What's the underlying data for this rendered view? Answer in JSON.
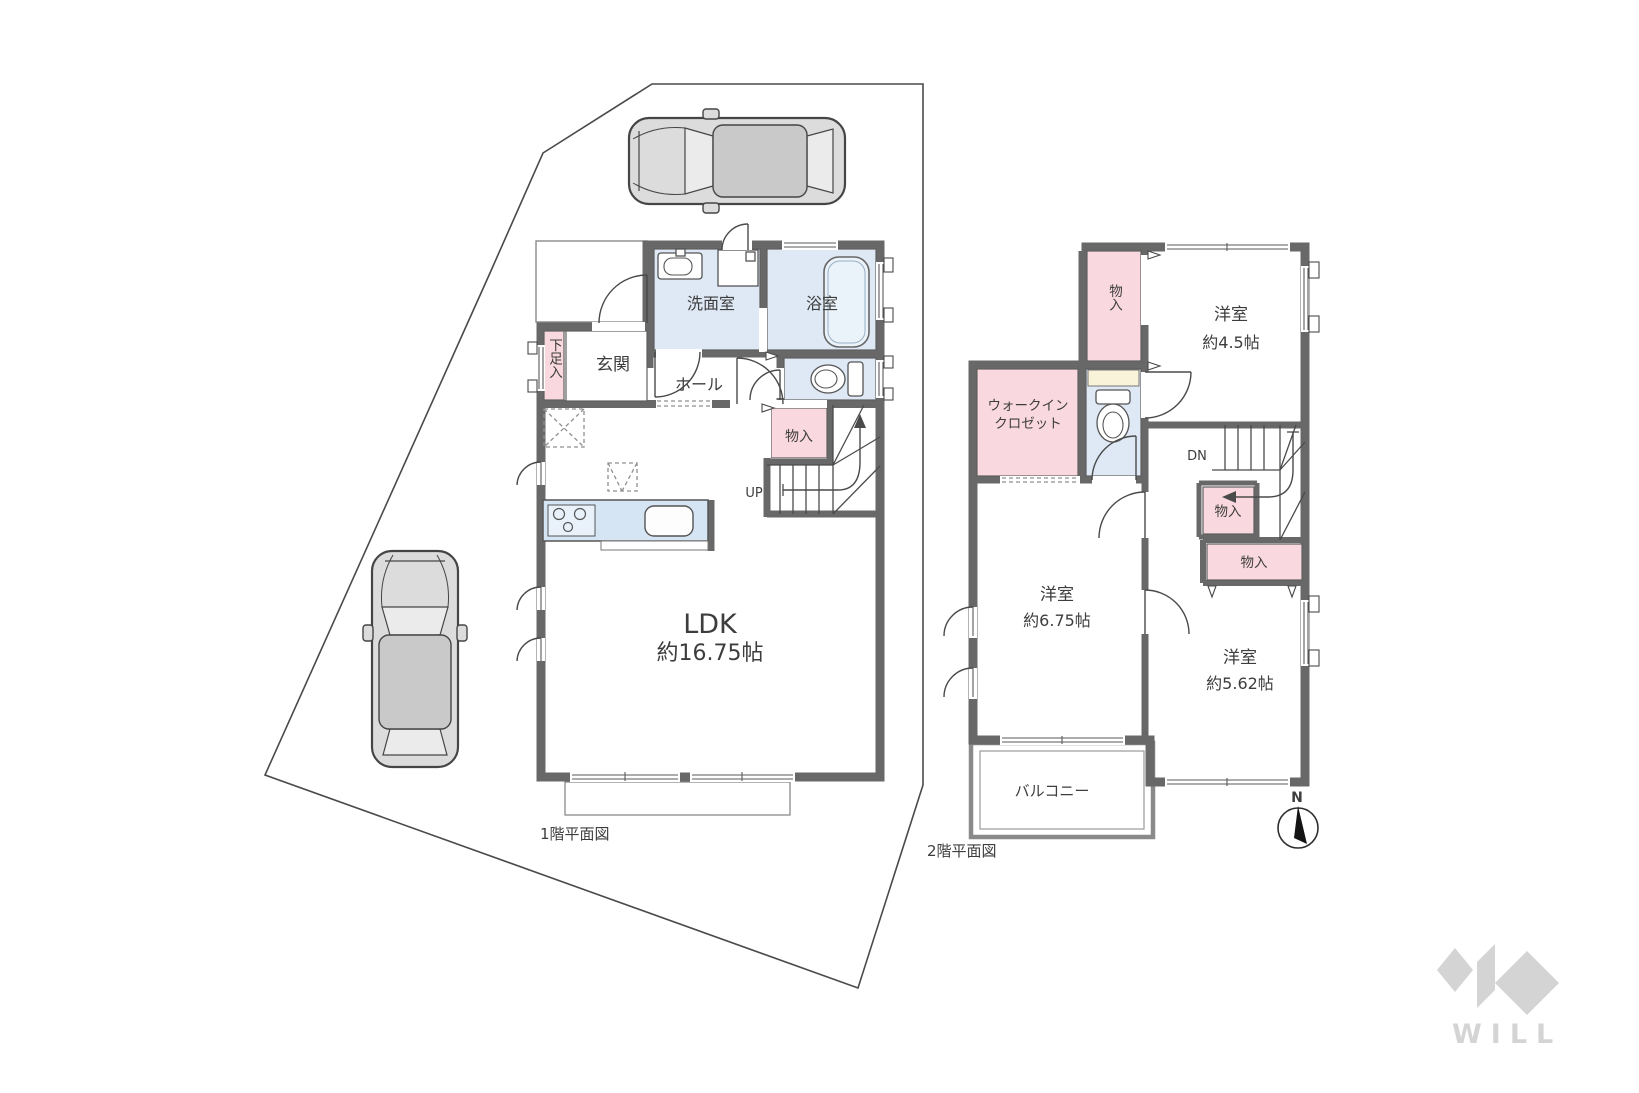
{
  "floor1": {
    "caption": "1階平面図",
    "ldk": {
      "name": "LDK",
      "area": "約16.75帖"
    },
    "entrance": "玄関",
    "shoe_storage": "下足入",
    "hall": "ホール",
    "washroom": "洗面室",
    "bathroom": "浴室",
    "storage": "物入",
    "stairs_label": "UP"
  },
  "floor2": {
    "caption": "2階平面図",
    "room_a": {
      "name": "洋室",
      "area": "約4.5帖"
    },
    "room_b": {
      "name": "洋室",
      "area": "約6.75帖"
    },
    "room_c": {
      "name": "洋室",
      "area": "約5.62帖"
    },
    "wic": {
      "line1": "ウォークイン",
      "line2": "クロゼット"
    },
    "storage_top": "物入",
    "storage_mid": "物入",
    "storage_wide": "物入",
    "balcony": "バルコニー",
    "stairs_label": "DN",
    "compass_label": "N"
  },
  "watermark": {
    "brand": "WILL"
  },
  "colors": {
    "wall": "#686868",
    "room_beige": "#f6ecd9",
    "wet_blue": "#dfe9f5",
    "storage_pink": "#f9d9df",
    "shelf_cream": "#f8f3d9",
    "kitchen_blue": "#d5e5f3",
    "car_gray": "#dcdcdc",
    "logo_gray": "#d4d4d4",
    "line": "#4a4a4a",
    "text": "#3d3d3d"
  }
}
